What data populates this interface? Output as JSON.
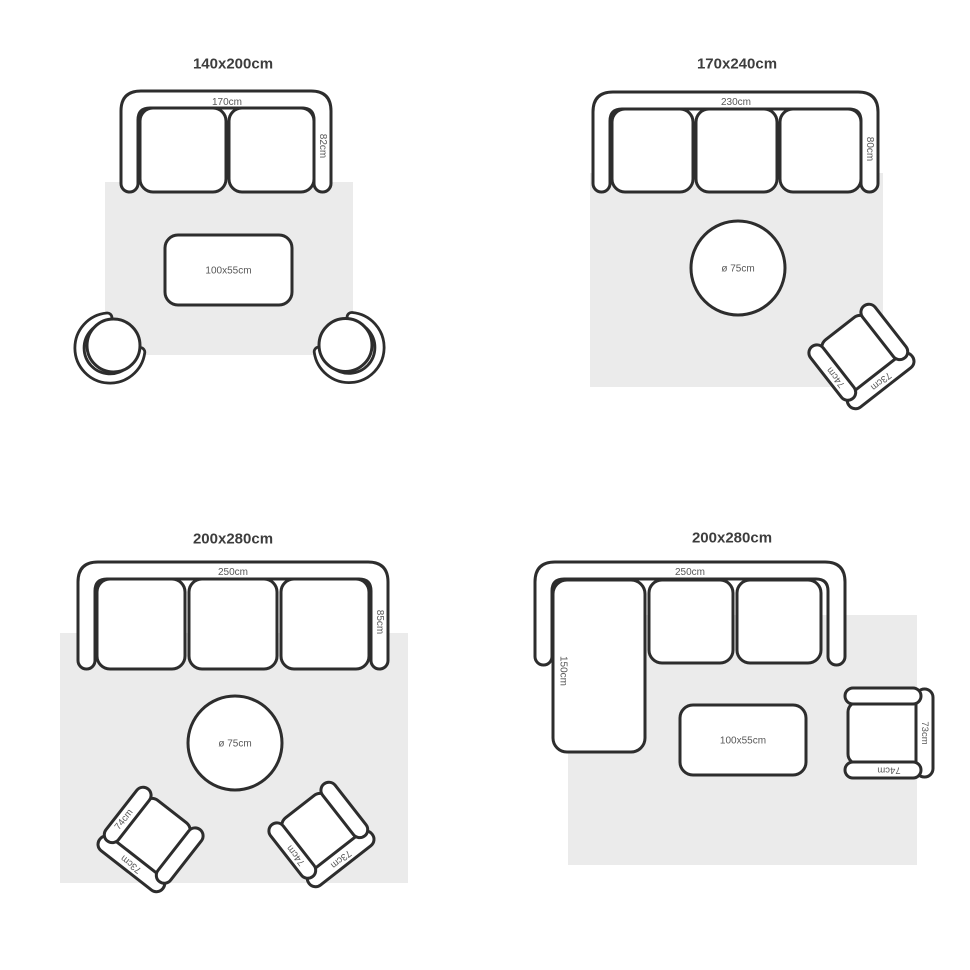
{
  "colors": {
    "background": "#ffffff",
    "rug": "#ebebeb",
    "outline": "#2d2d2d",
    "title_text": "#3d3d3d",
    "dimension_text": "#585858"
  },
  "quadrants": [
    {
      "title": "140x200cm",
      "sofa_width": "170cm",
      "sofa_depth": "82cm",
      "coffee_table": "100x55cm"
    },
    {
      "title": "170x240cm",
      "sofa_width": "230cm",
      "sofa_depth": "80cm",
      "round_table": "ø 75cm",
      "chair": {
        "arm": "74cm",
        "back": "73cm"
      }
    },
    {
      "title": "200x280cm",
      "sofa_width": "250cm",
      "sofa_depth": "85cm",
      "round_table": "ø 75cm",
      "chair_left": {
        "arm": "74cm",
        "back": "73cm"
      },
      "chair_right": {
        "arm": "74cm",
        "back": "73cm"
      }
    },
    {
      "title": "200x280cm",
      "sofa_width": "250cm",
      "chaise_depth": "150cm",
      "coffee_table": "100x55cm",
      "chair": {
        "arm": "74cm",
        "back": "73cm"
      }
    }
  ]
}
